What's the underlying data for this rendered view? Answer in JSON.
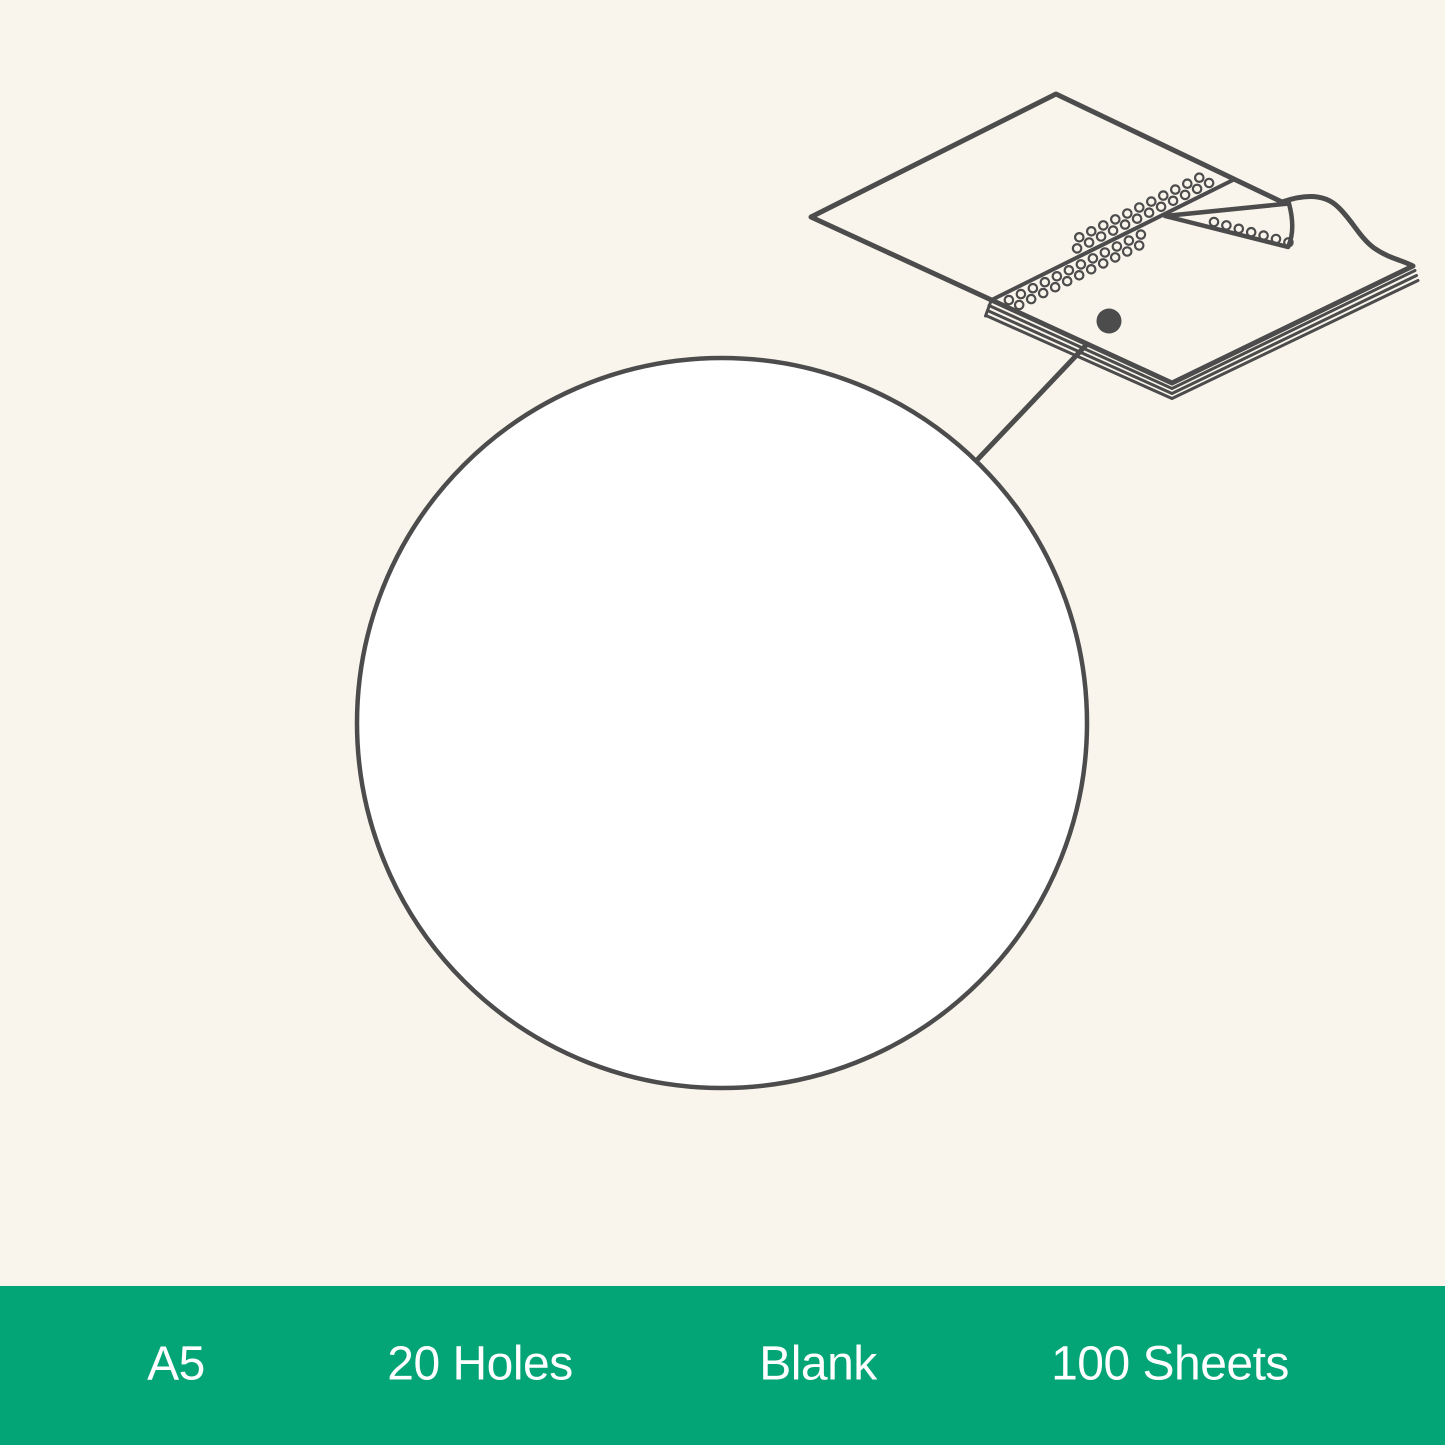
{
  "page": {
    "background_color": "#faf5ec",
    "width_px": 1445,
    "height_px": 1445
  },
  "illustration": {
    "stroke_color": "#4c4c4c",
    "notebook_fill": "#faf5ec",
    "magnifier_fill": "#ffffff",
    "elements": [
      "notebook-spread-line-art",
      "spine-punch-holes",
      "page-curl",
      "callout-dot",
      "callout-leader-line",
      "magnifier-circle"
    ]
  },
  "banner": {
    "background_color": "#03a476",
    "text_color": "#ffffff",
    "labels": [
      {
        "id": "size",
        "label": "A5"
      },
      {
        "id": "holes",
        "label": "20 Holes"
      },
      {
        "id": "ruling",
        "label": "Blank"
      },
      {
        "id": "sheets",
        "label": "100 Sheets"
      }
    ]
  }
}
